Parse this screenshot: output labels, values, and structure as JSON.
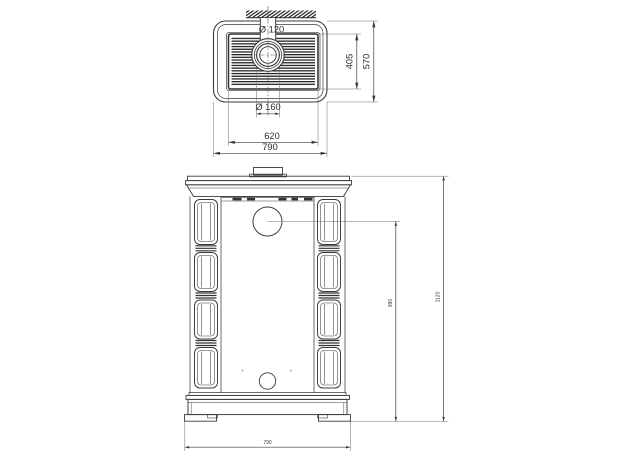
{
  "drawing": {
    "colors": {
      "background": "#ffffff",
      "line": "#3a3a3a",
      "dark_detail": "#2b2b2b"
    },
    "top_view": {
      "labels": {
        "pipe_diameter": "Ø 120",
        "collar_diameter": "Ø 160",
        "grille_width": "620",
        "overall_width": "790",
        "grille_depth": "405",
        "overall_depth": "570"
      }
    },
    "front_view": {
      "labels": {
        "flue_height": "990",
        "overall_height": "1120",
        "overall_width": "790"
      }
    }
  }
}
